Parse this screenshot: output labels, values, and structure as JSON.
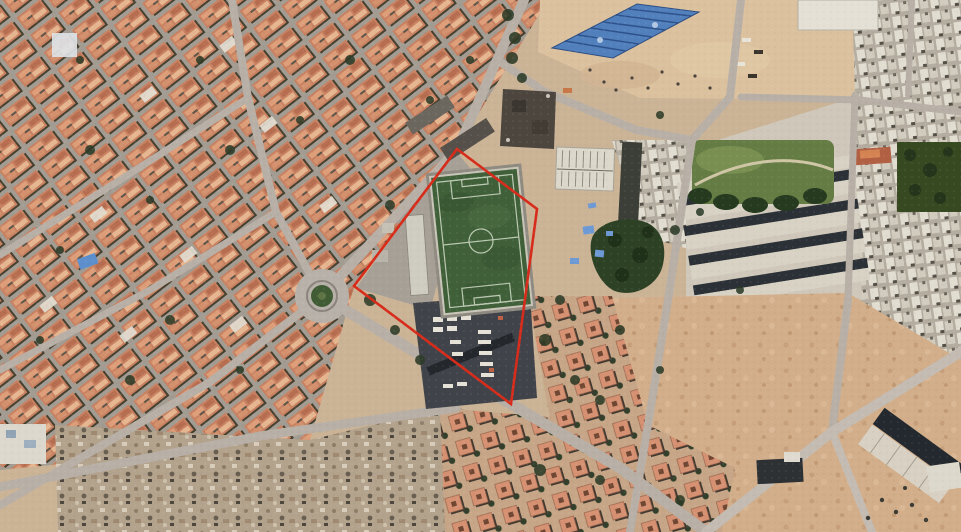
{
  "scene": {
    "type": "satellite-photo",
    "width_px": 961,
    "height_px": 532,
    "description": "Aerial satellite photograph of a dense North-African style urban neighbourhood. A red boundary polygon highlights a walled football pitch with an adjacent vehicle depot, situated between a traffic roundabout to the west and parks, row housing and sandy vacant lots to the east."
  },
  "palette": {
    "sand": "#d4ae88",
    "road": "#b8b0a6",
    "terracotta_roof": "#cb8160",
    "white_building": "#e2ddd0",
    "dark_vegetation": "#2c3b26",
    "pitch_green": "#3f6138",
    "pitch_lines": "#dce4d0",
    "annotation_red": "#de2a18",
    "blue_roof": "#4f80c0",
    "shadow_dark": "#2b3136",
    "rubble": "#b4a28b"
  },
  "annotation_polygon": {
    "label": "site-boundary",
    "points": [
      [
        457,
        149
      ],
      [
        537,
        209
      ],
      [
        511,
        404
      ],
      [
        354,
        286
      ]
    ],
    "stroke_color": "#de2a18",
    "stroke_width": 2.6
  },
  "landmarks": [
    {
      "id": "football-pitch",
      "kind": "sports-field",
      "center_px": [
        481,
        241
      ],
      "size_px": [
        86,
        136
      ],
      "rotation_deg": -6,
      "markings": [
        "perimeter line",
        "halfway line",
        "centre circle",
        "penalty areas",
        "goal boxes"
      ]
    },
    {
      "id": "roundabout",
      "kind": "traffic-circle",
      "center_px": [
        322,
        296
      ],
      "outer_radius_px": 27,
      "island_radius_px": 11
    },
    {
      "id": "blue-roofed-hall",
      "kind": "building",
      "vertices_px": [
        [
          552,
          48
        ],
        [
          637,
          4
        ],
        [
          699,
          12
        ],
        [
          613,
          58
        ]
      ],
      "roof_color": "#4f80c0"
    },
    {
      "id": "public-park",
      "kind": "green-space",
      "bounds_px": [
        692,
        140,
        142,
        64
      ]
    },
    {
      "id": "vehicle-depot",
      "kind": "yard",
      "bounds_px": [
        413,
        294,
        124,
        115
      ]
    },
    {
      "id": "tree-grove",
      "kind": "vegetation",
      "bounds_px": [
        586,
        215,
        80,
        82
      ]
    },
    {
      "id": "rubble-field",
      "kind": "demolition-area",
      "bounds_px": [
        55,
        405,
        500,
        127
      ]
    },
    {
      "id": "sand-lots",
      "kind": "vacant-land",
      "bounds_px": [
        608,
        293,
        353,
        239
      ]
    },
    {
      "id": "market-plaza",
      "kind": "open-square",
      "bounds_px": [
        538,
        0,
        334,
        100
      ]
    },
    {
      "id": "dark-flat-building",
      "kind": "building",
      "bounds_px": [
        502,
        88,
        54,
        60
      ]
    },
    {
      "id": "ribbed-hall",
      "kind": "building",
      "bounds_px": [
        556,
        148,
        58,
        42
      ]
    }
  ],
  "districts": [
    {
      "id": "west-terracotta-grid",
      "style": "diagonal terracotta block grid",
      "area": "left half"
    },
    {
      "id": "southeast-courtyard-clusters",
      "style": "square courtyard houses with trees",
      "area": "bottom centre"
    },
    {
      "id": "east-white-city",
      "style": "dense small white blocks",
      "area": "right edge"
    },
    {
      "id": "northeast-row-housing",
      "style": "parallel white rows with dark tree lines",
      "area": "right middle"
    }
  ]
}
